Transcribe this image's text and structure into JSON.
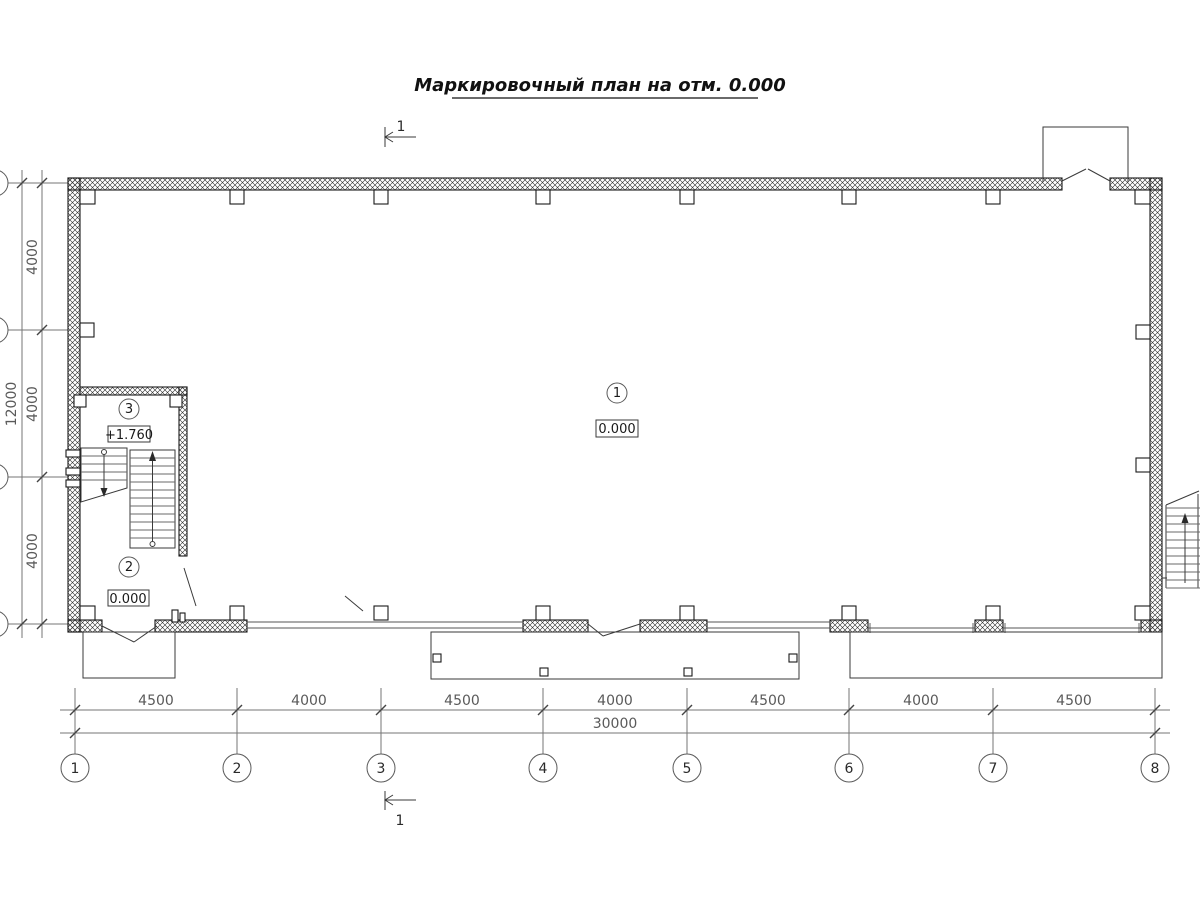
{
  "title": "Маркировочный план на отм. 0.000",
  "section_marks": {
    "top": "1",
    "bottom": "1"
  },
  "rooms": [
    {
      "number": "1",
      "elevation": "0.000"
    },
    {
      "number": "2",
      "elevation": "0.000"
    },
    {
      "number": "3",
      "elevation": "+1.760"
    }
  ],
  "grid": {
    "columns": [
      "1",
      "2",
      "3",
      "4",
      "5",
      "6",
      "7",
      "8"
    ],
    "column_dims": [
      "4500",
      "4000",
      "4500",
      "4000",
      "4500",
      "4000",
      "4500"
    ],
    "total_width": "30000",
    "row_dims": [
      "4000",
      "4000",
      "4000"
    ],
    "total_height": "12000"
  },
  "colors": {
    "line": "#1a1a1a",
    "dimension": "#767676",
    "background": "#ffffff"
  }
}
